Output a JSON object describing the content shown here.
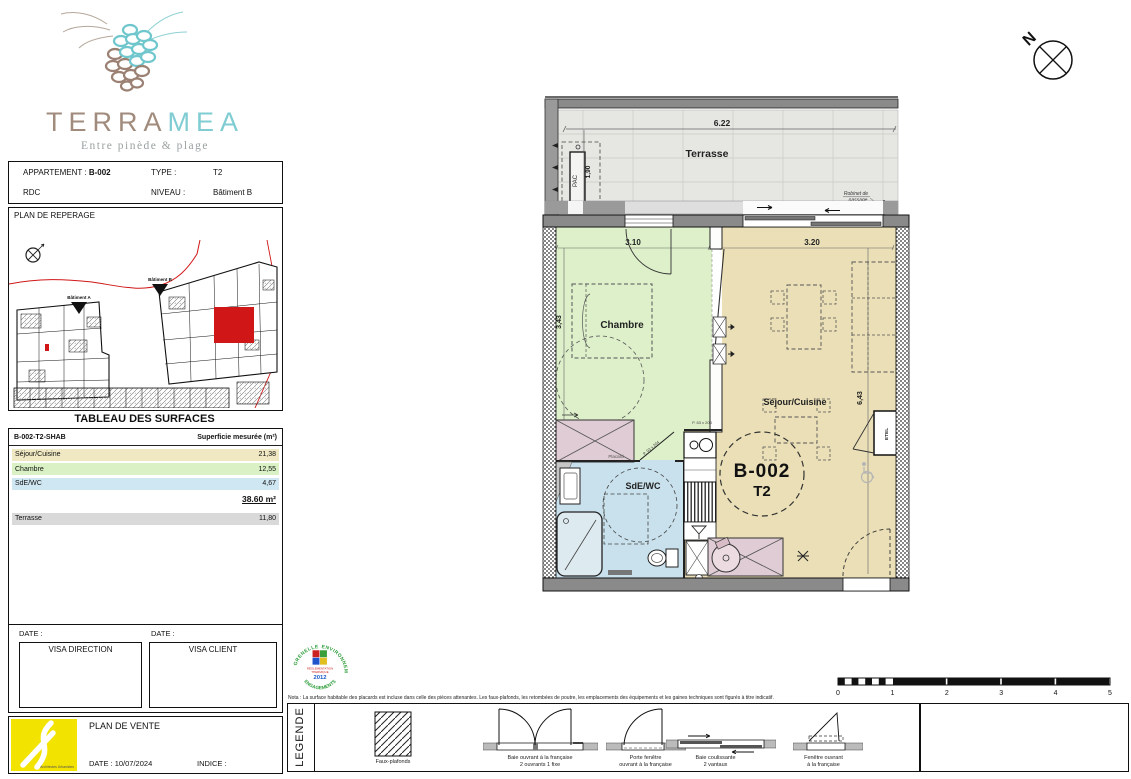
{
  "brand": {
    "terra": "TERRA",
    "mea": "MEA",
    "tagline": "Entre pinède & plage"
  },
  "header": {
    "apartment_label": "APPARTEMENT :",
    "apartment_value": "B-002",
    "type_label": "TYPE :",
    "type_value": "T2",
    "floor": "RDC",
    "level_label": "NIVEAU :",
    "level_value": "Bâtiment B"
  },
  "reperage": {
    "title": "PLAN DE REPERAGE",
    "building_a": "Bâtiment A",
    "building_b": "Bâtiment B"
  },
  "surfaces": {
    "title": "TABLEAU DES SURFACES",
    "col_name": "B-002-T2-SHAB",
    "col_value": "Superficie mesurée (m²)",
    "rows": [
      {
        "label": "Séjour/Cuisine",
        "value": "21,38",
        "color": "#efe8c2"
      },
      {
        "label": "Chambre",
        "value": "12,55",
        "color": "#d9f1c4"
      },
      {
        "label": "SdE/WC",
        "value": "4,67",
        "color": "#cfe7f3"
      }
    ],
    "total": "38.60 m²",
    "terrasse_label": "Terrasse",
    "terrasse_value": "11,80",
    "terrasse_color": "#d9d9d9"
  },
  "visa": {
    "date_label": "DATE :",
    "direction": "VISA DIRECTION",
    "client": "VISA CLIENT"
  },
  "titleblock": {
    "title": "PLAN DE VENTE",
    "date": "DATE : 10/07/2024",
    "indice": "INDICE :",
    "logo_caption": "Architectes Urbanistes"
  },
  "stamp": {
    "arc_left": "GRENELLE",
    "arc_right": "ENVIRONNEMENT",
    "arc_bottom": "ENGAGEMENTS",
    "line1": "RÉGLEMENTATION",
    "line2": "THERMIQUE",
    "year": "2012",
    "color": "#2e9e3c"
  },
  "nota": "Nota : La surface habitable des placards est incluse dans celle des pièces attenantes. Les faux-plafonds, les retombées de poutre, les emplacements des équipements et les gaines techniques sont figurés à titre indicatif.",
  "legend": {
    "title": "LEGENDE",
    "items": [
      {
        "label1": "Faux-plafonds",
        "label2": ""
      },
      {
        "label1": "Baie ouvrant à la française",
        "label2": "2 ouvrants 1 fixe"
      },
      {
        "label1": "Porte fenêtre",
        "label2": "ouvrant à la française"
      },
      {
        "label1": "Baie coulissante",
        "label2": "2 vantaux"
      },
      {
        "label1": "Fenêtre ouvrant",
        "label2": "à la française"
      }
    ]
  },
  "scalebar": {
    "ticks": [
      "0",
      "1",
      "2",
      "3",
      "4",
      "5"
    ]
  },
  "north": {
    "label": "N"
  },
  "plan": {
    "terrasse": "Terrasse",
    "dim_terrasse": "6.22",
    "pac": "PAC",
    "dim_pac": "1,90",
    "robinet_line1": "Robinet de",
    "robinet_line2": "passage",
    "chambre": "Chambre",
    "dim_chambre_w": "3.10",
    "dim_chambre_h": "3,43",
    "sejour": "Séjour/Cuisine",
    "dim_sejour_w": "3.20",
    "dim_sejour_h": "6,43",
    "sde": "SdE/WC",
    "unit": "B-002",
    "unit_type": "T2",
    "etel": "ETEL",
    "placard": "Placard",
    "door_chambre": "P. 83 x 204",
    "door_sde": "P. 93 x 204"
  },
  "icons": {
    "north-indicator": "circle-with-cross",
    "compass": "circle-x-arrow",
    "wheelchair": "accessibility-symbol",
    "valve": "cross-tap",
    "asterisk": "technical-point"
  },
  "colors": {
    "brand_brown": "#a08b7c",
    "brand_teal": "#7fccd3",
    "room_sejour": "#eadfb6",
    "room_chambre": "#ddf0ca",
    "room_sde": "#c9e1ec",
    "room_placard": "#e0ccd4",
    "terrace": "#e6e6e3",
    "highlight_red": "#d01616",
    "logo_yellow": "#f2e300"
  }
}
